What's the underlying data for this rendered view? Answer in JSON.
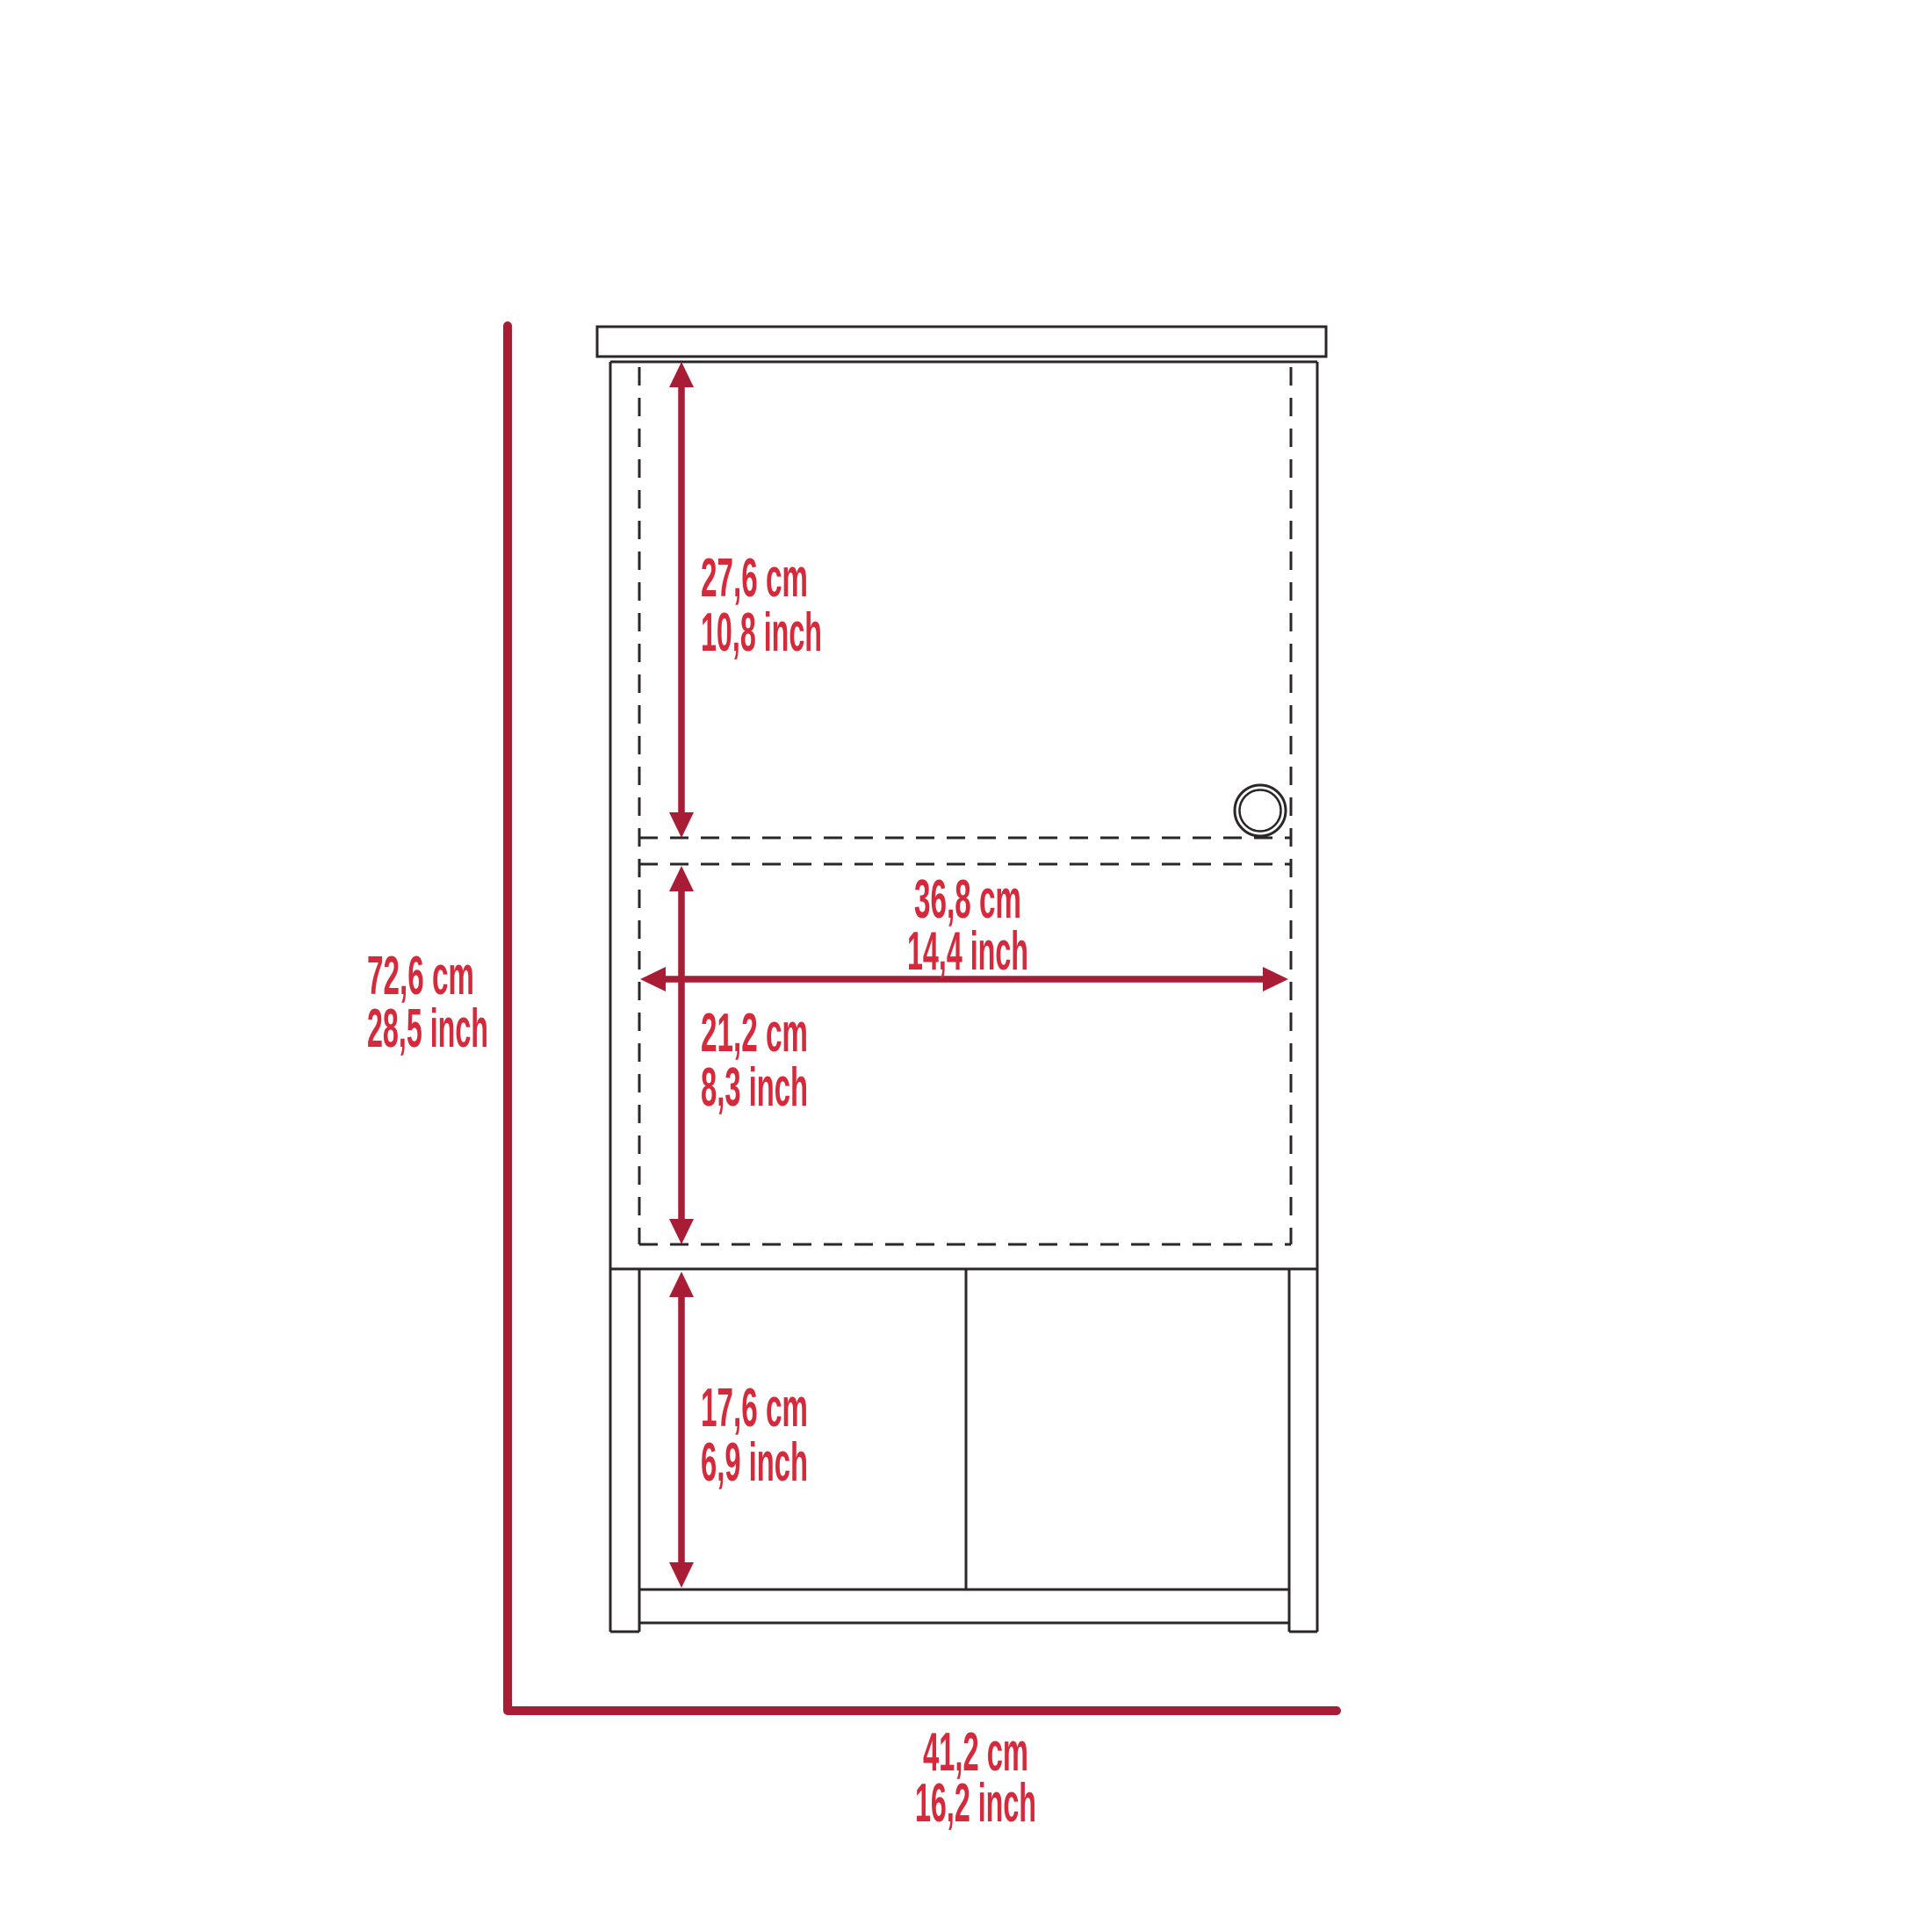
{
  "diagram": {
    "type": "furniture-dimension-diagram",
    "view": "cabinet front elevation",
    "colors": {
      "background": "#ffffff",
      "line_art": "#2b2728",
      "dimension_lines": "#a81d35",
      "dimension_text": "#d42a3c"
    },
    "dimensions": {
      "overall_height": {
        "cm": "72,6 cm",
        "inch": "28,5 inch"
      },
      "overall_width": {
        "cm": "41,2 cm",
        "inch": "16,2 inch"
      },
      "upper_door_height": {
        "cm": "27,6 cm",
        "inch": "10,8 inch"
      },
      "interior_width": {
        "cm": "36,8 cm",
        "inch": "14,4 inch"
      },
      "middle_section_height": {
        "cm": "21,2 cm",
        "inch": "8,3 inch"
      },
      "open_shelf_height": {
        "cm": "17,6 cm",
        "inch": "6,9 inch"
      }
    }
  }
}
